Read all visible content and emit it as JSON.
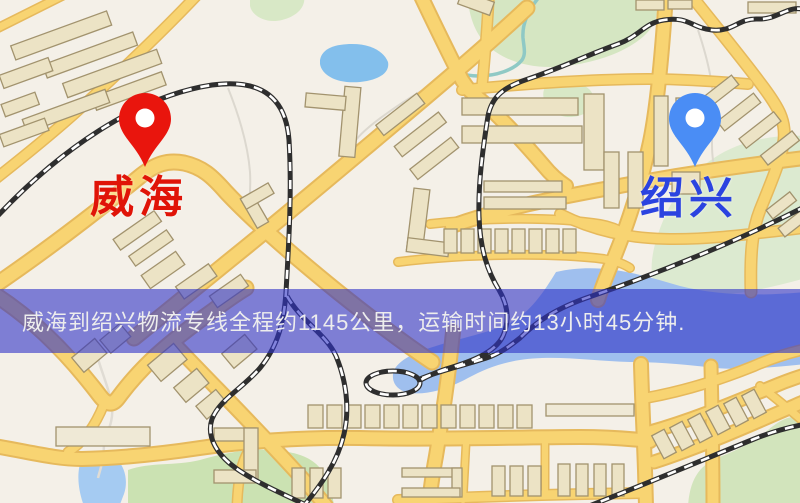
{
  "banner": {
    "text": "威海到绍兴物流专线全程约1145公里，运输时间约13小时45分钟.",
    "background_color": "#2f32c6",
    "text_color": "#ededed"
  },
  "route": {
    "origin": "威海",
    "destination": "绍兴",
    "distance": "约1145公里",
    "duration": "约13小时45分钟"
  },
  "markers": {
    "origin": {
      "label": "威海",
      "label_color": "#e01408",
      "pin_color": "#e9150d",
      "pin_icon": "red-map-pin"
    },
    "destination": {
      "label": "绍兴",
      "label_color": "#2b43e0",
      "pin_color": "#4a8df5",
      "pin_icon": "blue-map-pin"
    }
  },
  "map": {
    "style": "street-map",
    "colors": {
      "background": "#f4f0e8",
      "road_fill": "#f8d472",
      "road_casing": "#e6b95c",
      "building": "#ece3c5",
      "building_outline": "#a2936e",
      "park": "#cfe3b6",
      "water": "#9fc3ee",
      "railway": "#2e2e2e"
    }
  }
}
